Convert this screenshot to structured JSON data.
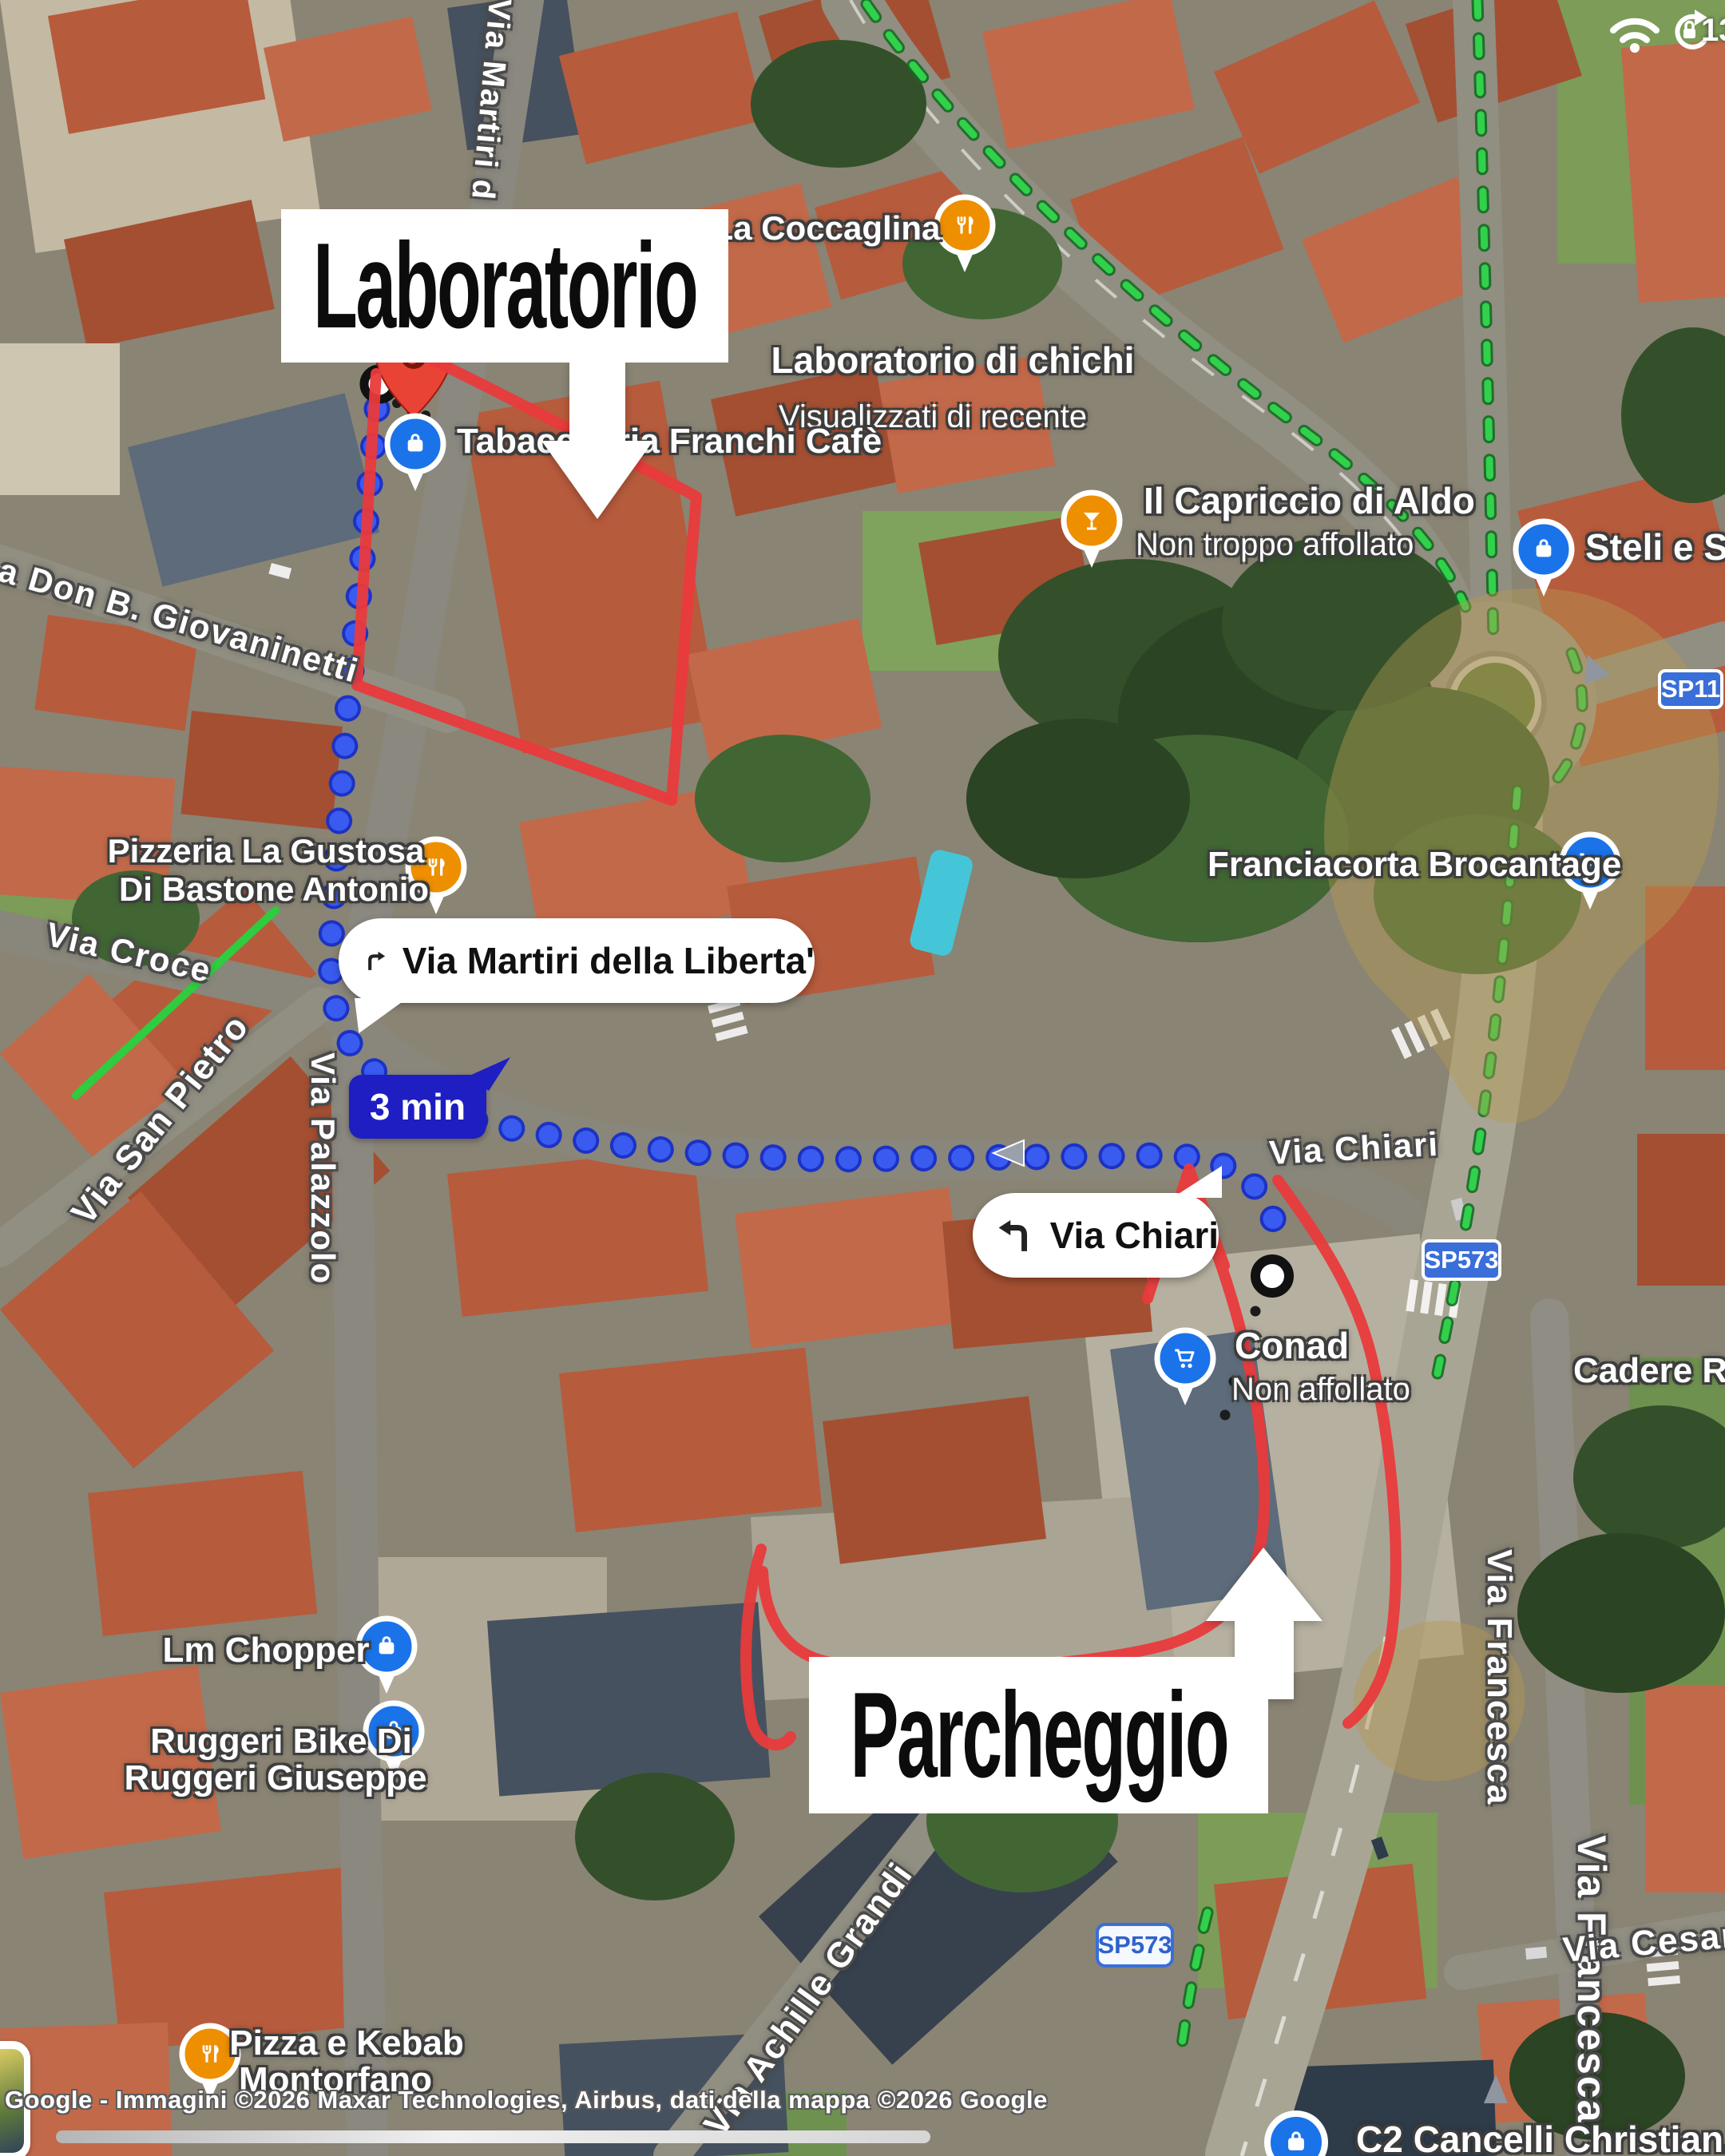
{
  "status_bar": {
    "battery_percent": "13"
  },
  "annotations": {
    "laboratorio": "Laboratorio",
    "parcheggio": "Parcheggio"
  },
  "navigation": {
    "duration_chip": "3 min",
    "turn_right_instruction": "Via Martiri della Liberta'",
    "turn_left_instruction": "Via Chiari"
  },
  "road_shields": {
    "sp11": "SP11",
    "sp573_mid": "SP573",
    "sp573_bottom": "SP573"
  },
  "pois": [
    {
      "line1": "La Coccaglina",
      "category": "restaurant"
    },
    {
      "line1": "Laboratorio di chichi",
      "line2": "Visualizzati di recente",
      "category": "recent-place"
    },
    {
      "line1": "Tabaccheria Franchi Cafè",
      "category": "shopping"
    },
    {
      "line1": "Il Capriccio di Aldo",
      "line2": "Non troppo affollato",
      "category": "bar"
    },
    {
      "line1": "Steli e Stili",
      "category": "shopping"
    },
    {
      "line1": "Pizzeria La Gustosa",
      "line2": "Di Bastone Antonio",
      "category": "restaurant"
    },
    {
      "line1": "Franciacorta Brocantage",
      "category": "supermarket"
    },
    {
      "line1": "Conad",
      "line2": "Non affollato",
      "category": "supermarket"
    },
    {
      "line1": "Lm Chopper",
      "category": "shopping"
    },
    {
      "line1": "Ruggeri Bike Di",
      "line2": "Ruggeri Giuseppe",
      "category": "shopping"
    },
    {
      "line1": "Pizza e Kebab",
      "line2": "Montorfano",
      "category": "restaurant"
    },
    {
      "line1": "C2 Cancelli Christian.",
      "category": "shopping"
    },
    {
      "line1": "Cadere Robe",
      "category": "place-label"
    }
  ],
  "streets": [
    {
      "label": "Via Martiri d"
    },
    {
      "label": "a Don B. Giovaninetti"
    },
    {
      "label": "Via Croce"
    },
    {
      "label": "Via San Pietro"
    },
    {
      "label": "Via Palazzolo"
    },
    {
      "label": "Via Chiari"
    },
    {
      "label": "Via Francesca"
    },
    {
      "label": "Via Cesare B"
    },
    {
      "label": "Via Achille Grandi"
    }
  ],
  "attribution": "Google - Immagini ©2026 Maxar Technologies, Airbus, dati della mappa ©2026 Google",
  "colors": {
    "route_blue": "#3550ec",
    "annotation_red": "#e93a3c",
    "poi_pin_blue": "#1a73e8",
    "poi_pin_orange": "#ee8f00",
    "duration_chip_navy": "#1e1ec2",
    "road_shield_blue": "#3a6ed8",
    "transit_green": "#31d14b",
    "area_highlight_tan": "#b49a52"
  }
}
